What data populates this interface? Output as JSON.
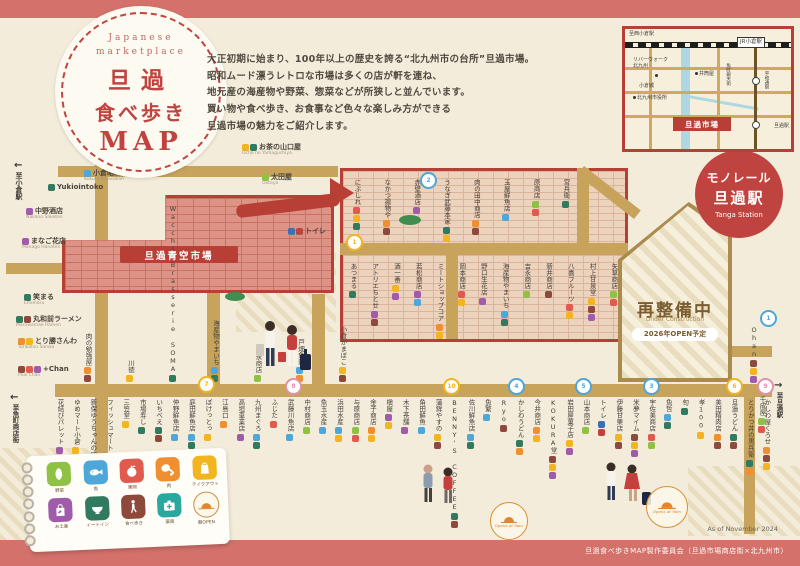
{
  "logo": {
    "tag1": "Japanese",
    "tag2": "marketplace",
    "title1": "旦過",
    "title2": "食べ歩き",
    "title3": "MAP"
  },
  "intro": {
    "lines": [
      "大正初期に始まり、100年以上の歴史を誇る“北九州市の台所”旦過市場。",
      "昭和ムード漂うレトロな市場は多くの店が軒を連ね、",
      "地元産の海産物や野菜、惣菜などが所狭しと並んでいます。",
      "買い物や食べ歩き、お食事など色々な楽しみ方ができる",
      "旦過市場の魅力をご紹介します。"
    ]
  },
  "minimap": {
    "to_nishikokura": "至西小倉駅",
    "jr_kokura": "JR小倉駅",
    "riverwalk": "リバーウォーク",
    "riverwalk2": "北九州",
    "izutsuya": "井筒屋",
    "kokura_castle": "小倉城",
    "city_hall": "北九州市役所",
    "heiwadori": "平和通駅",
    "uomachi": "魚町銀天街",
    "tanga_eki": "旦過駅",
    "tanga_market": "旦過市場"
  },
  "monorail": {
    "line1": "モノレール",
    "line2": "旦過駅",
    "en": "Tanga Station"
  },
  "construction": {
    "title": "再整備中",
    "en": "Under Construction",
    "note": "2026年OPEN予定"
  },
  "aozora": {
    "label": "旦過青空市場"
  },
  "directions": {
    "to_kokura": "至小倉駅",
    "to_uomachi": "至魚町商店街",
    "to_tanga": "至旦過駅"
  },
  "stamp": {
    "text": "Opens at 9am"
  },
  "footer": {
    "asof": "As of November 2024",
    "credit": "旦過食べ歩きMAP製作委員会（旦過市場商店街×北九州市）"
  },
  "palette": {
    "veg": "#8fc145",
    "fish": "#4da7d9",
    "fruit": "#e05a4e",
    "meat": "#ef8f2f",
    "takeout": "#f2b51f",
    "souvenir": "#a05caa",
    "eatin": "#31795f",
    "walk": "#8d4a3c",
    "pharmacy": "#2aa79e",
    "toiletman": "#3b6fb5",
    "toiletwoman": "#c4403c",
    "morning": "#c98f3f"
  },
  "pois": [
    {
      "name": "Yukiointoko",
      "x": 48,
      "y": 184,
      "icons": "eatin"
    },
    {
      "name": "小倉昭和館",
      "sub": "Kokura Showakan",
      "x": 84,
      "y": 170,
      "icons": "fish"
    },
    {
      "name": "中野酒店",
      "sub": "Nakano Saketen",
      "x": 26,
      "y": 208,
      "icons": "souvenir"
    },
    {
      "name": "まなご花店",
      "sub": "Manago Hanaten",
      "x": 22,
      "y": 238,
      "icons": "souvenir"
    },
    {
      "name": "お茶の山口屋",
      "sub": "Ocha no Yamaguchiya",
      "x": 242,
      "y": 144,
      "icons": "takeout,eatin"
    },
    {
      "name": "太田屋",
      "sub": "Ootaya",
      "x": 262,
      "y": 174,
      "icons": "veg"
    },
    {
      "name": "トイレ",
      "sub": "TOILET",
      "x": 288,
      "y": 228,
      "icons": "toiletman,toiletwoman"
    },
    {
      "name": "笑まる",
      "sub": "Emimaru",
      "x": 24,
      "y": 294,
      "icons": "eatin"
    },
    {
      "name": "丸和前ラーメン",
      "sub": "Maruwamae Ramen",
      "x": 16,
      "y": 316,
      "icons": "eatin,walk"
    },
    {
      "name": "とり勝さんわ",
      "sub": "Torikatsu Sanwa",
      "x": 18,
      "y": 338,
      "icons": "meat,takeout"
    },
    {
      "name": "+Chan",
      "sub": "Plus Chan",
      "x": 18,
      "y": 366,
      "icons": "walk,fruit,souvenir"
    }
  ],
  "inset_top": [
    {
      "name": "にぶしれ",
      "icons": "fruit,takeout,eatin"
    },
    {
      "name": "なかつ揚物や",
      "icons": "meat,walk"
    },
    {
      "name": "赤壁酒店",
      "icons": "souvenir"
    },
    {
      "name": "うなぎ武藤本家",
      "icons": "eatin,takeout"
    },
    {
      "name": "肉の田中商店",
      "icons": "meat,walk"
    },
    {
      "name": "玉屋鮮魚店",
      "icons": "fish"
    },
    {
      "name": "原商店",
      "icons": "veg,fruit"
    },
    {
      "name": "宮兵衛",
      "icons": "eatin"
    }
  ],
  "inset_bottom": [
    {
      "name": "あつまる",
      "icons": "eatin"
    },
    {
      "name": "アトリエちとせ",
      "icons": "souvenir,walk"
    },
    {
      "name": "酒一番",
      "icons": "takeout,souvenir"
    },
    {
      "name": "若松商店",
      "icons": "souvenir,fish"
    },
    {
      "name": "ミートショップコア",
      "icons": "meat,takeout"
    },
    {
      "name": "岡本商店",
      "icons": "fruit,takeout"
    },
    {
      "name": "野口生花店",
      "icons": "souvenir"
    },
    {
      "name": "海産物やまいち",
      "icons": "fish,eatin"
    },
    {
      "name": "吉永商店",
      "icons": "veg"
    },
    {
      "name": "新井商店",
      "icons": "walk"
    },
    {
      "name": "八喜フルーツ",
      "icons": "fruit,takeout"
    },
    {
      "name": "村上甘泉堂",
      "icons": "takeout,walk,souvenir"
    },
    {
      "name": "矢草商店",
      "icons": "veg,fruit"
    }
  ],
  "mid_row": [
    {
      "name": "肉の勉強屋",
      "icons": "meat,walk"
    },
    {
      "name": "川徳",
      "icons": "takeout"
    },
    {
      "name": "Wacchi Brasserie SOMA",
      "icons": "eatin"
    },
    {
      "name": "海産物やまいち",
      "icons": "fish,eatin"
    },
    {
      "name": "吉永商店",
      "icons": "veg"
    },
    {
      "name": "戸畑魚肉",
      "icons": "fish,meat"
    },
    {
      "name": "小倉かまぼこ",
      "icons": "takeout,walk"
    }
  ],
  "bottom_row": [
    {
      "name": "花結びパレット",
      "icons": "souvenir"
    },
    {
      "name": "ゆめマート小倉",
      "icons": "takeout"
    },
    {
      "name": "新保ゆうちゃんの店",
      "icons": "walk,takeout"
    },
    {
      "name": "フィッシュマート",
      "icons": "fish"
    },
    {
      "name": "三笠堂",
      "icons": "takeout"
    },
    {
      "name": "市場寿し",
      "icons": "eatin"
    },
    {
      "name": "いちべえ",
      "icons": "eatin,walk"
    },
    {
      "name": "仲野鮮魚店",
      "icons": "fish"
    },
    {
      "name": "庭田鮮魚店",
      "icons": "fish,eatin"
    },
    {
      "name": "ぽけっとっ",
      "icons": "takeout"
    },
    {
      "name": "江島口",
      "icons": "meat"
    },
    {
      "name": "高垣車業店",
      "icons": "souvenir"
    },
    {
      "name": "九州まぐろ",
      "icons": "fish,eatin"
    },
    {
      "name": "ふじた",
      "icons": "fruit"
    },
    {
      "name": "武藤川魚店",
      "icons": "fish"
    },
    {
      "name": "中村商店",
      "icons": "veg"
    },
    {
      "name": "魚玉水産",
      "icons": "fish"
    },
    {
      "name": "浜田水産",
      "icons": "fish,takeout"
    },
    {
      "name": "与原商店",
      "icons": "veg,fruit"
    },
    {
      "name": "金子商店",
      "icons": "meat,takeout"
    },
    {
      "name": "槇屋",
      "icons": "souvenir,takeout"
    },
    {
      "name": "木下茶舗",
      "icons": "souvenir"
    },
    {
      "name": "角田鮮魚",
      "icons": "fish"
    },
    {
      "name": "蒲鉾やすの",
      "icons": "takeout,walk"
    },
    {
      "name": "BENNY'S COFFEE",
      "icons": "eatin,walk"
    },
    {
      "name": "佐川鮮魚店",
      "icons": "fish,eatin"
    },
    {
      "name": "魚繁",
      "icons": "fish"
    },
    {
      "name": "Ryo",
      "icons": "walk"
    },
    {
      "name": "かしわうどん",
      "icons": "eatin,meat"
    },
    {
      "name": "今井商店",
      "icons": "meat,takeout"
    },
    {
      "name": "KOKURA堂",
      "icons": "walk,takeout,souvenir"
    },
    {
      "name": "岩田屋菓子店",
      "icons": "takeout,souvenir"
    },
    {
      "name": "山本商店",
      "icons": "veg"
    },
    {
      "name": "トイレ",
      "icons": "toiletman,toiletwoman"
    },
    {
      "name": "伊藤甘栗店",
      "icons": "takeout,walk"
    },
    {
      "name": "米夢マイム",
      "icons": "walk,takeout,souvenir"
    },
    {
      "name": "宇佐美商店",
      "icons": "fruit,veg"
    },
    {
      "name": "魚哲",
      "icons": "fish,eatin"
    },
    {
      "name": "旬",
      "icons": "eatin"
    },
    {
      "name": "孝100",
      "icons": "takeout"
    },
    {
      "name": "美田精肉店",
      "icons": "meat,walk"
    },
    {
      "name": "旦過うどん",
      "icons": "eatin,walk"
    },
    {
      "name": "とりかつ丼の黒兵衛",
      "icons": "eatin,meat"
    },
    {
      "name": "かしわ屋くろせ",
      "icons": "meat,walk,takeout"
    }
  ],
  "free_shops": [
    {
      "name": "Ohan",
      "x": 750,
      "y": 326,
      "icons": "walk,takeout,souvenir"
    },
    {
      "name": "千成屋",
      "x": 758,
      "y": 396,
      "icons": "veg,fruit"
    }
  ],
  "legend": {
    "items": [
      {
        "label": "野菜"
      },
      {
        "label": "魚"
      },
      {
        "label": "果物"
      },
      {
        "label": "肉"
      },
      {
        "label": "テイクアウト"
      },
      {
        "label": "お土産"
      },
      {
        "label": "イートイン"
      },
      {
        "label": "食べ歩き"
      },
      {
        "label": "薬局"
      },
      {
        "label": "朝OPEN"
      }
    ]
  },
  "pins": [
    {
      "x": 420,
      "y": 172,
      "c": "#4da7d9",
      "n": "2"
    },
    {
      "x": 346,
      "y": 234,
      "c": "#f2b51f",
      "n": "1"
    },
    {
      "x": 198,
      "y": 376,
      "c": "#f2b51f",
      "n": "7"
    },
    {
      "x": 285,
      "y": 378,
      "c": "#e38fae",
      "n": "8"
    },
    {
      "x": 443,
      "y": 378,
      "c": "#f2b51f",
      "n": "10"
    },
    {
      "x": 508,
      "y": 378,
      "c": "#4da7d9",
      "n": "4"
    },
    {
      "x": 575,
      "y": 378,
      "c": "#4da7d9",
      "n": "5"
    },
    {
      "x": 643,
      "y": 378,
      "c": "#4da7d9",
      "n": "3"
    },
    {
      "x": 726,
      "y": 378,
      "c": "#f2b51f",
      "n": "6"
    },
    {
      "x": 757,
      "y": 378,
      "c": "#e38fae",
      "n": "9"
    },
    {
      "x": 760,
      "y": 310,
      "c": "#4da7d9",
      "n": "1"
    }
  ]
}
